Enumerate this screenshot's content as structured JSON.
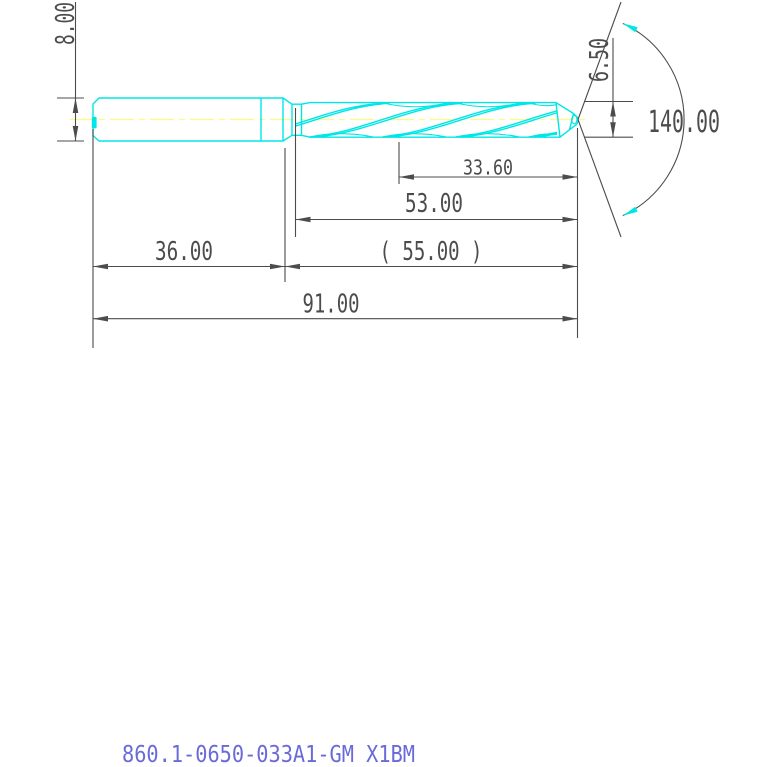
{
  "drawing": {
    "part_number": "860.1-0650-033A1-GM X1BM",
    "dimensions": {
      "shank_diameter": "8.00",
      "cutting_diameter": "6.50",
      "point_angle": "140.00",
      "step_length": "33.60",
      "flute_length": "53.00",
      "reference_length": "( 55.00 )",
      "shank_length": "36.00",
      "overall_length": "91.00"
    },
    "colors": {
      "geometry": "#00E6E6",
      "centerline": "#FBFB8A",
      "dimension_lines": "#4C4C4C",
      "part_number_text": "#6A6AD8",
      "background": "#FFFFFF"
    }
  }
}
